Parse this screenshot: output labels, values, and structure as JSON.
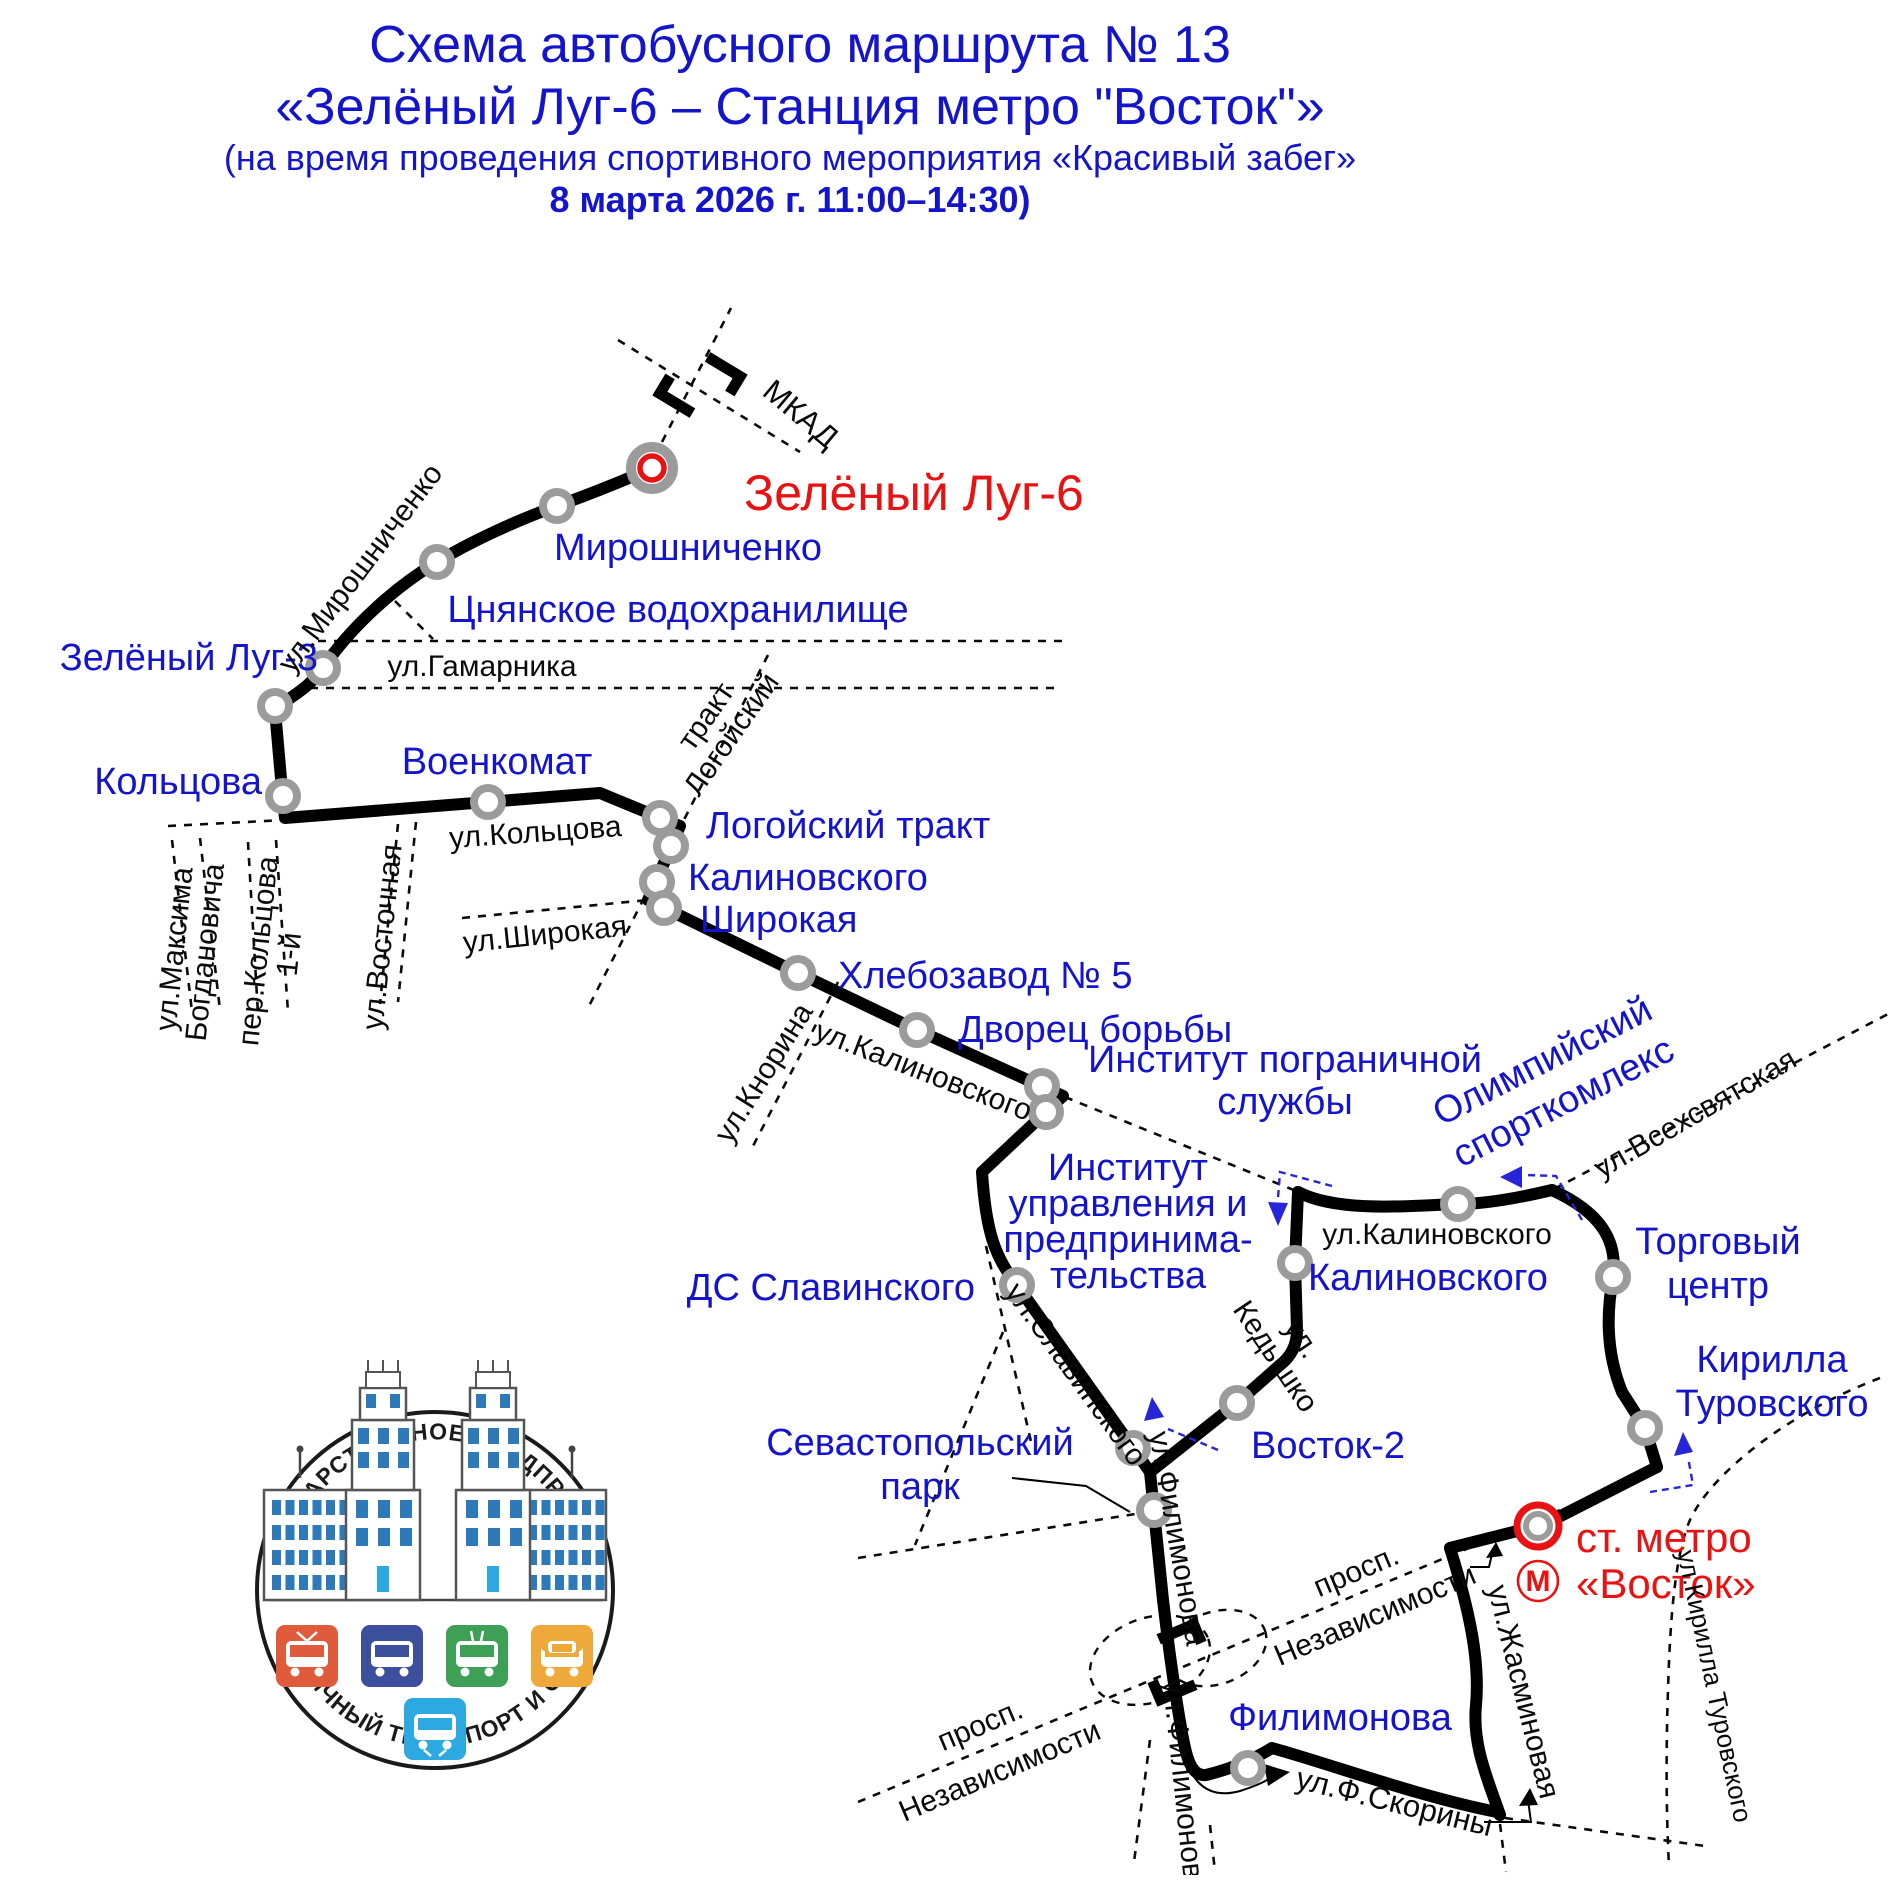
{
  "title": {
    "line1": "Схема автобусного маршрута № 13",
    "line2": "«Зелёный Луг-6 – Станция метро \"Восток\"»",
    "line3": "(на время проведения спортивного мероприятия «Красивый забег»",
    "line4": "8 марта 2026 г. 11:00–14:30)"
  },
  "colors": {
    "blue": "#1414CC",
    "red": "#E81212",
    "black": "#0A0A0A",
    "gray": "#9B9B9B",
    "route": "#000000",
    "arrow_blue": "#2626D8",
    "tile_tram": "#DF5B3B",
    "tile_bus": "#3C4F9C",
    "tile_trolley": "#3E9F56",
    "tile_car": "#EFA93B",
    "tile_metro": "#2BA9E0",
    "window_blue": "#2E79B8"
  },
  "logo": {
    "top": "ГОСУДАРСТВЕННОЕ ПРЕДПРИЯТИЕ",
    "bottom": "СТОЛИЧНЫЙ ТРАНСПОРТ И СВЯЗЬ"
  },
  "map": {
    "stops": [
      {
        "name": "terminal-zeleny-lug-6",
        "x": 652,
        "y": 468,
        "kind": "terminal-green"
      },
      {
        "name": "stop-miroshnichenko",
        "x": 557,
        "y": 506,
        "kind": "stop"
      },
      {
        "name": "stop-tsnyanskoye",
        "x": 437,
        "y": 562,
        "kind": "stop"
      },
      {
        "name": "stop-zeleny-lug-3",
        "x": 323,
        "y": 668,
        "kind": "stop"
      },
      {
        "name": "stop-zeleny-lug-3b",
        "x": 275,
        "y": 706,
        "kind": "stop"
      },
      {
        "name": "stop-koltsova",
        "x": 283,
        "y": 796,
        "kind": "stop"
      },
      {
        "name": "stop-voyenkomat",
        "x": 488,
        "y": 802,
        "kind": "stop"
      },
      {
        "name": "stop-logoysky-trakt",
        "x": 660,
        "y": 818,
        "kind": "stop"
      },
      {
        "name": "stop-kalinovskogo-a",
        "x": 671,
        "y": 846,
        "kind": "stop"
      },
      {
        "name": "stop-kalinovskogo-b",
        "x": 657,
        "y": 882,
        "kind": "stop"
      },
      {
        "name": "stop-shirokaya",
        "x": 664,
        "y": 908,
        "kind": "stop"
      },
      {
        "name": "stop-khlebozavod-5",
        "x": 798,
        "y": 973,
        "kind": "stop"
      },
      {
        "name": "stop-dvorets-borby",
        "x": 917,
        "y": 1030,
        "kind": "stop"
      },
      {
        "name": "stop-institut-pogranichnoy-a",
        "x": 1042,
        "y": 1086,
        "kind": "stop"
      },
      {
        "name": "stop-institut-pogranichnoy-b",
        "x": 1046,
        "y": 1112,
        "kind": "stop"
      },
      {
        "name": "stop-ds-slavinskogo",
        "x": 1017,
        "y": 1285,
        "kind": "stop"
      },
      {
        "name": "stop-sevastopolsky-a",
        "x": 1133,
        "y": 1448,
        "kind": "stop"
      },
      {
        "name": "stop-sevastopolsky-b",
        "x": 1154,
        "y": 1510,
        "kind": "stop"
      },
      {
        "name": "stop-vostok-2",
        "x": 1237,
        "y": 1403,
        "kind": "stop"
      },
      {
        "name": "stop-kalinovskogo-loop",
        "x": 1295,
        "y": 1263,
        "kind": "stop"
      },
      {
        "name": "stop-olimpiysky",
        "x": 1458,
        "y": 1204,
        "kind": "stop"
      },
      {
        "name": "stop-torgovy-tsentr",
        "x": 1613,
        "y": 1277,
        "kind": "stop"
      },
      {
        "name": "stop-kirilla-turovskogo",
        "x": 1645,
        "y": 1428,
        "kind": "stop"
      },
      {
        "name": "stop-filimonova",
        "x": 1248,
        "y": 1768,
        "kind": "stop"
      },
      {
        "name": "terminal-metro-vostok",
        "x": 1538,
        "y": 1526,
        "kind": "terminal-metro"
      }
    ],
    "labels": [
      {
        "name": "label-zeleny-lug-6",
        "lines": [
          "Зелёный Луг-6"
        ],
        "x": 744,
        "y": 510,
        "size": 50,
        "color": "red",
        "anchor": "start"
      },
      {
        "name": "label-miroshnichenko",
        "lines": [
          "Мирошниченко"
        ],
        "x": 688,
        "y": 560,
        "color": "blue"
      },
      {
        "name": "label-tsnyanskoye",
        "lines": [
          "Цнянское водохранилище"
        ],
        "x": 678,
        "y": 622,
        "color": "blue"
      },
      {
        "name": "label-zeleny-lug-3",
        "lines": [
          "Зелёный Луг-3"
        ],
        "x": 318,
        "y": 670,
        "color": "blue",
        "anchor": "end"
      },
      {
        "name": "label-koltsova",
        "lines": [
          "Кольцова"
        ],
        "x": 262,
        "y": 794,
        "color": "blue",
        "anchor": "end"
      },
      {
        "name": "label-voyenkomat",
        "lines": [
          "Военкомат"
        ],
        "x": 497,
        "y": 774,
        "color": "blue"
      },
      {
        "name": "label-logoysky-trakt",
        "lines": [
          "Логойский тракт"
        ],
        "x": 706,
        "y": 838,
        "color": "blue",
        "anchor": "start"
      },
      {
        "name": "label-kalinovskogo",
        "lines": [
          "Калиновского"
        ],
        "x": 688,
        "y": 890,
        "color": "blue",
        "anchor": "start"
      },
      {
        "name": "label-shirokaya",
        "lines": [
          "Широкая"
        ],
        "x": 700,
        "y": 932,
        "color": "blue",
        "anchor": "start"
      },
      {
        "name": "label-khlebozavod-5",
        "lines": [
          "Хлебозавод № 5"
        ],
        "x": 838,
        "y": 988,
        "color": "blue",
        "anchor": "start"
      },
      {
        "name": "label-dvorets-borby",
        "lines": [
          "Дворец борьбы"
        ],
        "x": 958,
        "y": 1042,
        "color": "blue",
        "anchor": "start"
      },
      {
        "name": "label-institut-pogranichnoy",
        "lines": [
          "Институт пограничной",
          "службы"
        ],
        "x": 1285,
        "y": 1072,
        "lh": 42,
        "color": "blue"
      },
      {
        "name": "label-institut-upravleniya",
        "lines": [
          "Институт",
          "управления и",
          "предпринима-",
          "тельства"
        ],
        "x": 1128,
        "y": 1180,
        "lh": 36,
        "color": "blue"
      },
      {
        "name": "label-ds-slavinskogo",
        "lines": [
          "ДС Славинского"
        ],
        "x": 975,
        "y": 1300,
        "color": "blue",
        "anchor": "end"
      },
      {
        "name": "label-sevastopolsky-park",
        "lines": [
          "Севастопольский",
          "парк"
        ],
        "x": 920,
        "y": 1455,
        "lh": 44,
        "color": "blue"
      },
      {
        "name": "label-vostok-2",
        "lines": [
          "Восток-2"
        ],
        "x": 1328,
        "y": 1458,
        "color": "blue"
      },
      {
        "name": "label-kalinovskogo-loop",
        "lines": [
          "Калиновского"
        ],
        "x": 1428,
        "y": 1290,
        "color": "blue"
      },
      {
        "name": "label-olimpiysky-sportkomleks",
        "lines": [
          "Олимпийский",
          "спорткомлекс"
        ],
        "x": 1548,
        "y": 1072,
        "rot": -27,
        "lh": 46,
        "color": "blue"
      },
      {
        "name": "label-torgovy-tsentr",
        "lines": [
          "Торговый",
          "центр"
        ],
        "x": 1718,
        "y": 1254,
        "lh": 44,
        "color": "blue"
      },
      {
        "name": "label-kirilla-turovskogo",
        "lines": [
          "Кирилла",
          "Туровского"
        ],
        "x": 1772,
        "y": 1372,
        "lh": 44,
        "color": "blue"
      },
      {
        "name": "label-filimonova",
        "lines": [
          "Филимонова"
        ],
        "x": 1340,
        "y": 1730,
        "color": "blue"
      },
      {
        "name": "label-st-metro-vostok",
        "lines": [
          "ст. метро",
          "«Восток»"
        ],
        "x": 1576,
        "y": 1552,
        "lh": 46,
        "size": 42,
        "color": "red",
        "anchor": "start"
      },
      {
        "name": "label-metro-m",
        "lines": [
          "М"
        ],
        "x": 1538,
        "y": 1591,
        "size": 30,
        "color": "red",
        "bold": true
      },
      {
        "name": "label-mkad",
        "lines": [
          "МКАД"
        ],
        "x": 794,
        "y": 422,
        "rot": 40,
        "size": 31,
        "color": "black"
      },
      {
        "name": "street-miroshnichenko",
        "lines": [
          "ул.Мирошниченко"
        ],
        "x": 368,
        "y": 574,
        "rot": -53,
        "size": 30,
        "color": "black"
      },
      {
        "name": "street-gamarnika",
        "lines": [
          "ул.Гамарника"
        ],
        "x": 482,
        "y": 676,
        "size": 30,
        "color": "black"
      },
      {
        "name": "street-maksima-bogdanovicha",
        "lines": [
          "ул.Максима",
          "Богдановича"
        ],
        "x": 184,
        "y": 950,
        "rot": -84,
        "lh": 31,
        "size": 30,
        "color": "black"
      },
      {
        "name": "street-per-koltsova",
        "lines": [
          "пер.Кольцова",
          "1-й"
        ],
        "x": 268,
        "y": 952,
        "rot": -84,
        "lh": 31,
        "size": 30,
        "color": "black"
      },
      {
        "name": "street-vostochnaya",
        "lines": [
          "ул.Восточная"
        ],
        "x": 392,
        "y": 938,
        "rot": -84,
        "size": 30,
        "color": "black"
      },
      {
        "name": "street-koltsova",
        "lines": [
          "ул.Кольцова"
        ],
        "x": 536,
        "y": 842,
        "rot": -4,
        "size": 30,
        "color": "black"
      },
      {
        "name": "street-trakt-logoysky",
        "lines": [
          "тракт",
          "Логойский"
        ],
        "x": 714,
        "y": 722,
        "rot": -55,
        "lh": 31,
        "size": 30,
        "color": "black"
      },
      {
        "name": "street-shirokaya",
        "lines": [
          "ул.Широкая"
        ],
        "x": 546,
        "y": 944,
        "rot": -6,
        "size": 30,
        "color": "black"
      },
      {
        "name": "street-knorina",
        "lines": [
          "ул.Кнорина"
        ],
        "x": 772,
        "y": 1078,
        "rot": -58,
        "size": 30,
        "color": "black"
      },
      {
        "name": "street-kalinovskogo",
        "lines": [
          "ул.Калиновского"
        ],
        "x": 920,
        "y": 1080,
        "rot": 21,
        "size": 30,
        "color": "black"
      },
      {
        "name": "street-kalinovskogo-loop",
        "lines": [
          "ул.Калиновского"
        ],
        "x": 1437,
        "y": 1244,
        "size": 30,
        "color": "black"
      },
      {
        "name": "street-vsekhsvyatskaya",
        "lines": [
          "ул.Всехсвятская"
        ],
        "x": 1700,
        "y": 1122,
        "rot": -30,
        "size": 30,
        "color": "black"
      },
      {
        "name": "street-slavinskogo",
        "lines": [
          "ул.Славинского"
        ],
        "x": 1068,
        "y": 1380,
        "rot": 54,
        "size": 30,
        "color": "black"
      },
      {
        "name": "street-kedyshko",
        "lines": [
          "ул.",
          "Кедышко"
        ],
        "x": 1294,
        "y": 1344,
        "rot": 56,
        "lh": 32,
        "size": 30,
        "color": "black"
      },
      {
        "name": "street-filimonova-route",
        "lines": [
          "ул.Филимонова"
        ],
        "x": 1168,
        "y": 1540,
        "rot": 80,
        "size": 30,
        "color": "black"
      },
      {
        "name": "street-filimonova-lower",
        "lines": [
          "ул.Филимонова"
        ],
        "x": 1174,
        "y": 1788,
        "rot": 84,
        "size": 30,
        "color": "black"
      },
      {
        "name": "street-nezavisimosti-left",
        "lines": [
          "просп.",
          "Независимости"
        ],
        "x": 984,
        "y": 1734,
        "rot": -23,
        "lh": 50,
        "size": 30,
        "color": "black"
      },
      {
        "name": "street-nezavisimosti-right",
        "lines": [
          "просп.",
          "Независимости"
        ],
        "x": 1360,
        "y": 1580,
        "rot": -23,
        "lh": 48,
        "size": 30,
        "color": "black"
      },
      {
        "name": "street-f-skoriny",
        "lines": [
          "ул.Ф.Скорины"
        ],
        "x": 1392,
        "y": 1812,
        "rot": 14,
        "size": 31,
        "color": "black"
      },
      {
        "name": "street-zhasminovaya",
        "lines": [
          "ул.Жасминовая"
        ],
        "x": 1514,
        "y": 1694,
        "rot": 76,
        "size": 30,
        "color": "black"
      },
      {
        "name": "street-kirilla-turovskogo",
        "lines": [
          "ул.Кирилла Туровского"
        ],
        "x": 1706,
        "y": 1688,
        "rot": 78,
        "size": 26,
        "color": "black"
      }
    ]
  }
}
